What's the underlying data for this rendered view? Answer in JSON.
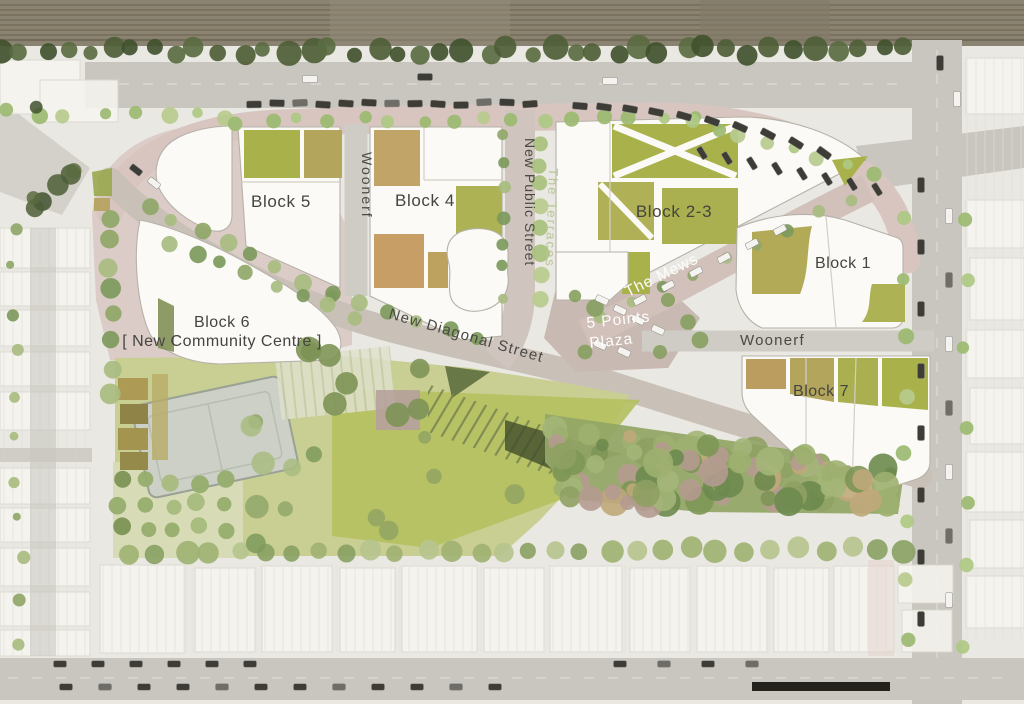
{
  "plan": {
    "labels": {
      "block5": "Block 5",
      "block4": "Block 4",
      "block23": "Block 2-3",
      "block1": "Block 1",
      "block7": "Block 7",
      "block6_title": "Block 6",
      "block6_subtitle": "[ New Community Centre ]",
      "woonerf_west": "Woonerf",
      "woonerf_east": "Woonerf",
      "new_public_street": "New Public Street",
      "the_terraces": "The Terraces",
      "the_mews": "The Mews",
      "five_points_line1": "5 Points",
      "five_points_line2": "Plaza",
      "new_diagonal_street": "New Diagonal Street"
    },
    "palette": {
      "block_white": "#fbfaf6",
      "paving_pink": "#d9c5c0",
      "road_grey": "#c9c6bf",
      "lawn_green": "#b5c05f",
      "courtyard_green": "#a9b14b",
      "courtyard_tan": "#c49d66",
      "woodland_green": "#93a766",
      "railway_brown": "#8b8371",
      "label_dark": "#45443f",
      "label_white": "#fdfdfb",
      "label_terraces_green": "#b9c695"
    }
  }
}
